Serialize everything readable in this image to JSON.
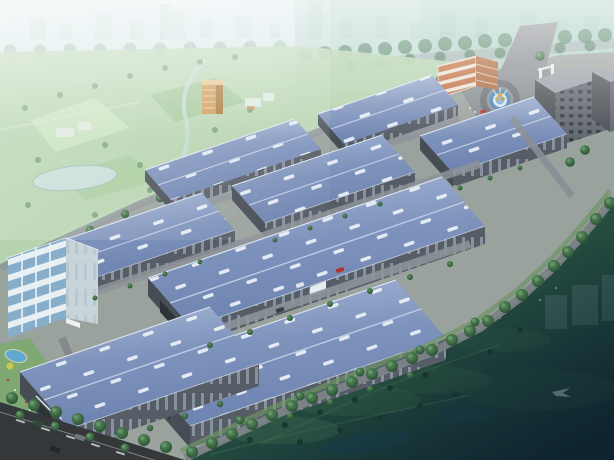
{
  "image": {
    "kind": "architectural aerial rendering",
    "subject": "Bird's-eye perspective rendering of an industrial logistics park with rows of blue-roofed warehouse buildings",
    "visible_text": [],
    "width_px": 614,
    "height_px": 460
  },
  "scene": {
    "background": [
      "hazy pale city skyline",
      "teal-green atmospheric haze on right",
      "rows of roadside trees",
      "farm fields with lake and stream",
      "orange high-rise tower",
      "small white village buildings"
    ],
    "midground": [
      "three large blue-roof warehouses",
      "three medium warehouses",
      "two small back-row warehouses",
      "white five-storey office building with glass facade",
      "orange three-storey office building",
      "entrance plaza with circular fountain and gold sculpture",
      "two dark dormitory blocks",
      "internal roads with trees and cars"
    ],
    "foreground": [
      "tree-lined boundary road",
      "dark green field with faint park features",
      "city road with dashed lane lines and cars",
      "landscaped garden with pool and palm trees"
    ],
    "counts": {
      "large_warehouses": 3,
      "medium_warehouses": 3,
      "small_warehouses": 2,
      "office_buildings": 2,
      "dormitory_blocks": 2,
      "fountains": 1
    }
  },
  "palette": {
    "warehouse_roof": "#8098c0",
    "warehouse_wall": "#575d66",
    "skylight": "#edf2f8",
    "haze_sky": "#cfe2e4",
    "teal_city": "#8fc0ad",
    "field_green": "#b2d2a8",
    "dark_field": "#1d4032",
    "road": "#7d8287",
    "asphalt": "#34383b",
    "tree": "#2f5c3a",
    "office_glass": "#86aecb",
    "orange_building": "#c0703f",
    "fountain_water": "#4e86b8",
    "sculpture_gold": "#c9a13d"
  }
}
